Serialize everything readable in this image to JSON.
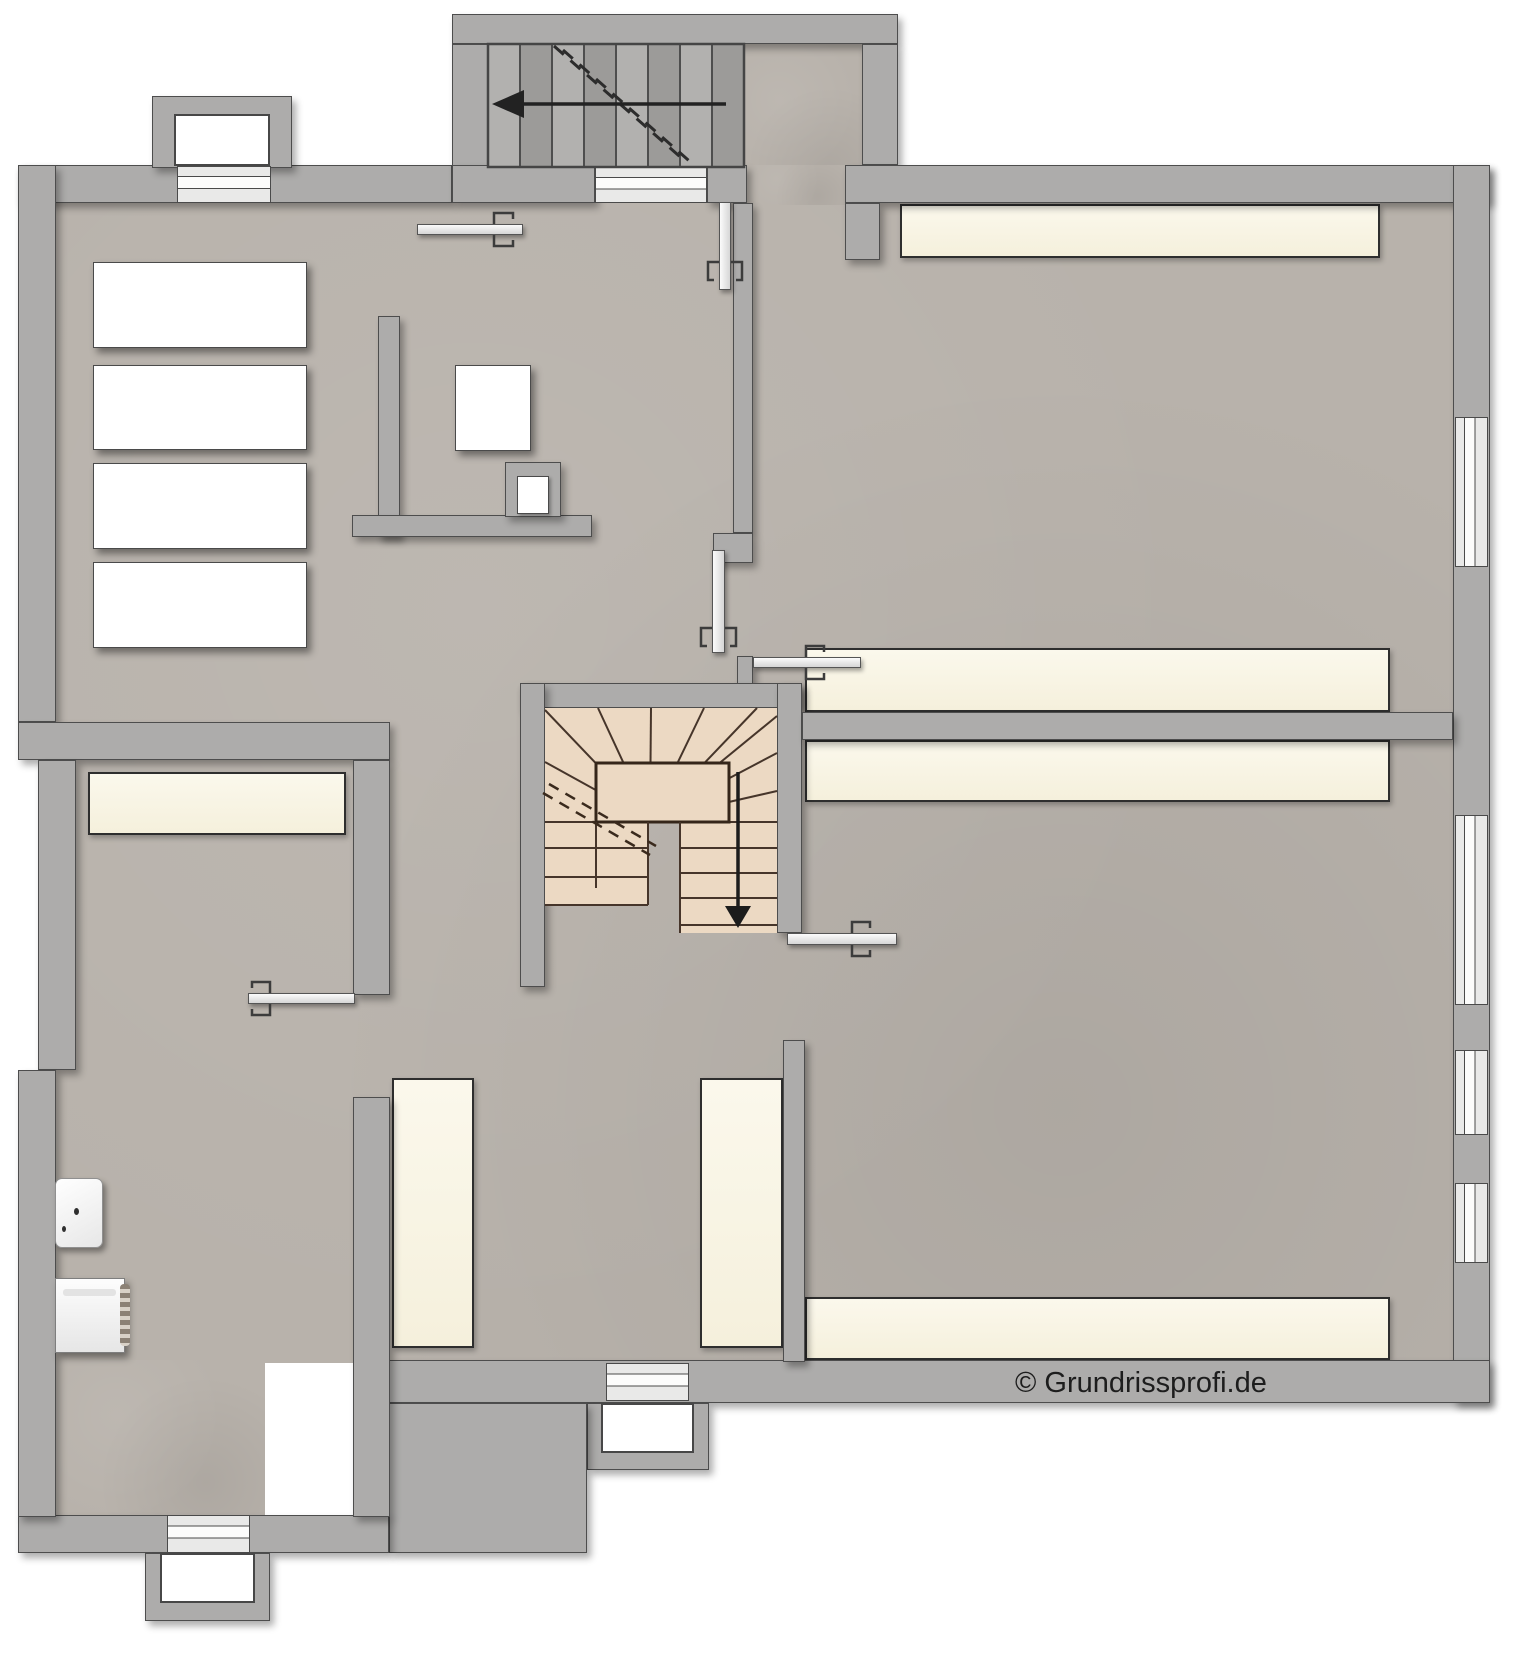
{
  "canvas": {
    "w": 1520,
    "h": 1656
  },
  "copyright": {
    "text": "© Grundrissprofi.de",
    "x": 1015,
    "y": 1367
  },
  "palette": {
    "floor": "#b8b2ab",
    "wall": "#adacab",
    "wall_line": "#4d4d4d",
    "platform_cream": "#f9f6e8",
    "stair_tread": "#ecd9c3",
    "stair_line": "#46352a",
    "exterior_tread": "#a7a6a4"
  },
  "plan": {
    "floors": [
      {
        "name": "floor-main",
        "x": 53,
        "y": 200,
        "w": 1402,
        "h": 1163
      },
      {
        "name": "floor-bottom-left-room",
        "x": 53,
        "y": 1360,
        "w": 212,
        "h": 157
      },
      {
        "name": "floor-stair-landing",
        "x": 744,
        "y": 44,
        "w": 118,
        "h": 160
      },
      {
        "name": "floor-top-opening",
        "x": 747,
        "y": 165,
        "w": 98,
        "h": 40
      }
    ],
    "platforms": [
      {
        "name": "platform-top-right-room",
        "x": 900,
        "y": 204,
        "w": 480,
        "h": 54
      },
      {
        "name": "platform-upper-right-room-bottom",
        "x": 805,
        "y": 648,
        "w": 585,
        "h": 64
      },
      {
        "name": "platform-lower-right-room-top",
        "x": 805,
        "y": 740,
        "w": 585,
        "h": 62
      },
      {
        "name": "platform-lower-right-room-bottom",
        "x": 805,
        "y": 1297,
        "w": 585,
        "h": 63
      },
      {
        "name": "platform-left-room-top",
        "x": 88,
        "y": 772,
        "w": 258,
        "h": 63
      },
      {
        "name": "platform-middle-room-left",
        "x": 392,
        "y": 1078,
        "w": 82,
        "h": 270
      },
      {
        "name": "platform-middle-room-right",
        "x": 700,
        "y": 1078,
        "w": 83,
        "h": 270
      }
    ],
    "walls": [
      {
        "name": "wall-top-left",
        "x": 18,
        "y": 165,
        "w": 434,
        "h": 38
      },
      {
        "name": "lightwell-top-left-ring",
        "x": 152,
        "y": 96,
        "w": 140,
        "h": 72
      },
      {
        "name": "wall-exterior-stair-top",
        "x": 452,
        "y": 14,
        "w": 446,
        "h": 30
      },
      {
        "name": "wall-exterior-stair-left",
        "x": 452,
        "y": 44,
        "w": 36,
        "h": 123
      },
      {
        "name": "wall-exterior-stair-right",
        "x": 862,
        "y": 44,
        "w": 36,
        "h": 121
      },
      {
        "name": "wall-under-stair-a",
        "x": 452,
        "y": 165,
        "w": 143,
        "h": 38
      },
      {
        "name": "wall-under-stair-b",
        "x": 707,
        "y": 165,
        "w": 40,
        "h": 38
      },
      {
        "name": "wall-top-right",
        "x": 845,
        "y": 165,
        "w": 645,
        "h": 38
      },
      {
        "name": "wall-stub-top-right",
        "x": 845,
        "y": 203,
        "w": 35,
        "h": 57
      },
      {
        "name": "wall-right",
        "x": 1453,
        "y": 165,
        "w": 37,
        "h": 1238
      },
      {
        "name": "wall-bottom-right",
        "x": 389,
        "y": 1360,
        "w": 1101,
        "h": 43
      },
      {
        "name": "lightwell-bottom-middle-ring",
        "x": 587,
        "y": 1403,
        "w": 122,
        "h": 67
      },
      {
        "name": "wall-block-bottom",
        "x": 389,
        "y": 1403,
        "w": 198,
        "h": 150
      },
      {
        "name": "wall-bottom-left",
        "x": 18,
        "y": 1515,
        "w": 371,
        "h": 38
      },
      {
        "name": "lightwell-bottom-left-ring",
        "x": 145,
        "y": 1553,
        "w": 125,
        "h": 68
      },
      {
        "name": "wall-left-upper",
        "x": 18,
        "y": 165,
        "w": 38,
        "h": 557
      },
      {
        "name": "wall-divider-left-rooms",
        "x": 18,
        "y": 722,
        "w": 372,
        "h": 38
      },
      {
        "name": "wall-left-middle",
        "x": 38,
        "y": 760,
        "w": 38,
        "h": 310
      },
      {
        "name": "wall-left-lower",
        "x": 18,
        "y": 1070,
        "w": 38,
        "h": 447
      },
      {
        "name": "wall-leftroom-right-upper",
        "x": 353,
        "y": 760,
        "w": 37,
        "h": 235
      },
      {
        "name": "wall-leftroom-right-lower",
        "x": 353,
        "y": 1097,
        "w": 37,
        "h": 420
      },
      {
        "name": "partition-storage-vertical",
        "x": 378,
        "y": 316,
        "w": 22,
        "h": 221
      },
      {
        "name": "partition-storage-horizontal",
        "x": 352,
        "y": 515,
        "w": 240,
        "h": 22
      },
      {
        "name": "partition-chimney-bump",
        "x": 505,
        "y": 462,
        "w": 56,
        "h": 55
      },
      {
        "name": "wall-middle-vertical",
        "x": 733,
        "y": 203,
        "w": 20,
        "h": 330
      },
      {
        "name": "wall-middle-foot",
        "x": 713,
        "y": 533,
        "w": 40,
        "h": 30
      },
      {
        "name": "wall-stub-door-jamb",
        "x": 737,
        "y": 656,
        "w": 16,
        "h": 29
      },
      {
        "name": "stair-enclosure-top",
        "x": 520,
        "y": 683,
        "w": 282,
        "h": 25
      },
      {
        "name": "stair-enclosure-left",
        "x": 520,
        "y": 683,
        "w": 25,
        "h": 304
      },
      {
        "name": "stair-enclosure-right",
        "x": 777,
        "y": 683,
        "w": 25,
        "h": 250
      },
      {
        "name": "wall-middle-room-right",
        "x": 783,
        "y": 1040,
        "w": 22,
        "h": 322
      },
      {
        "name": "wall-divider-right-rooms",
        "x": 802,
        "y": 712,
        "w": 651,
        "h": 28
      }
    ],
    "whites": [
      {
        "name": "lightwell-top-left-inner",
        "cls": "well-inner",
        "x": 174,
        "y": 114,
        "w": 96,
        "h": 52
      },
      {
        "name": "lightwell-bottom-middle-inner",
        "cls": "well-inner",
        "x": 601,
        "y": 1403,
        "w": 93,
        "h": 50
      },
      {
        "name": "lightwell-bottom-left-inner",
        "cls": "well-inner",
        "x": 160,
        "y": 1553,
        "w": 95,
        "h": 50
      },
      {
        "name": "shelf-1",
        "cls": "shelf",
        "x": 93,
        "y": 262,
        "w": 214,
        "h": 86
      },
      {
        "name": "shelf-2",
        "cls": "shelf",
        "x": 93,
        "y": 365,
        "w": 214,
        "h": 85
      },
      {
        "name": "shelf-3",
        "cls": "shelf",
        "x": 93,
        "y": 463,
        "w": 214,
        "h": 86
      },
      {
        "name": "shelf-4",
        "cls": "shelf",
        "x": 93,
        "y": 562,
        "w": 214,
        "h": 86
      },
      {
        "name": "table-box",
        "cls": "shelf",
        "x": 455,
        "y": 365,
        "w": 76,
        "h": 86
      },
      {
        "name": "chimney-inner-box",
        "cls": "small-box",
        "x": 517,
        "y": 476,
        "w": 32,
        "h": 38
      }
    ],
    "windows_h": [
      {
        "name": "window-top-left",
        "x": 177,
        "y": 166,
        "w": 94,
        "h": 37
      },
      {
        "name": "window-under-stair",
        "x": 595,
        "y": 167,
        "w": 112,
        "h": 36
      },
      {
        "name": "window-bottom-left",
        "x": 167,
        "y": 1515,
        "w": 83,
        "h": 38
      },
      {
        "name": "window-bottom-middle",
        "x": 606,
        "y": 1363,
        "w": 83,
        "h": 38
      }
    ],
    "windows_v": [
      {
        "name": "window-right-1",
        "x": 1455,
        "y": 417,
        "w": 33,
        "h": 150
      },
      {
        "name": "window-right-2",
        "x": 1455,
        "y": 815,
        "w": 33,
        "h": 190
      },
      {
        "name": "window-right-3",
        "x": 1455,
        "y": 1050,
        "w": 33,
        "h": 85
      },
      {
        "name": "window-right-4",
        "x": 1455,
        "y": 1183,
        "w": 33,
        "h": 80
      }
    ],
    "doors": [
      {
        "name": "door-storage-room",
        "dir": "h",
        "x": 417,
        "y": 224,
        "w": 106,
        "h": 11
      },
      {
        "name": "door-top-entry",
        "dir": "v",
        "x": 719,
        "y": 202,
        "w": 12,
        "h": 88
      },
      {
        "name": "door-corridor-middle",
        "dir": "v",
        "x": 712,
        "y": 550,
        "w": 13,
        "h": 103
      },
      {
        "name": "door-upper-right-room",
        "dir": "h",
        "x": 753,
        "y": 657,
        "w": 108,
        "h": 11
      },
      {
        "name": "door-lower-right-room",
        "dir": "h",
        "x": 787,
        "y": 933,
        "w": 110,
        "h": 12
      },
      {
        "name": "door-left-room",
        "dir": "h",
        "x": 248,
        "y": 993,
        "w": 107,
        "h": 11
      }
    ],
    "objects": [
      {
        "name": "sink",
        "cls": "sink",
        "x": 55,
        "y": 1178,
        "w": 48,
        "h": 70
      },
      {
        "name": "sink-drain-dot",
        "cls": "dot",
        "x": 74,
        "y": 1208,
        "w": 5,
        "h": 7
      },
      {
        "name": "sink-tap-dot",
        "cls": "dot",
        "x": 62,
        "y": 1226,
        "w": 4,
        "h": 6
      },
      {
        "name": "heater-boiler",
        "cls": "heater",
        "x": 55,
        "y": 1278,
        "w": 70,
        "h": 75
      },
      {
        "name": "heater-groove",
        "cls": "groove",
        "x": 63,
        "y": 1289,
        "w": 53,
        "h": 7
      },
      {
        "name": "heater-coil",
        "cls": "coil",
        "x": 120,
        "y": 1284,
        "w": 10,
        "h": 62
      }
    ]
  },
  "svg_shapes": [
    {
      "t": "rect",
      "x": 488,
      "y": 44,
      "w": 256,
      "h": 123,
      "f": "#a7a6a4"
    },
    {
      "t": "rect",
      "x": 488,
      "y": 44,
      "w": 32,
      "h": 123,
      "f": "#b2b1af"
    },
    {
      "t": "rect",
      "x": 520,
      "y": 44,
      "w": 32,
      "h": 123,
      "f": "#9c9b99"
    },
    {
      "t": "rect",
      "x": 552,
      "y": 44,
      "w": 32,
      "h": 123,
      "f": "#b2b1af"
    },
    {
      "t": "rect",
      "x": 584,
      "y": 44,
      "w": 32,
      "h": 123,
      "f": "#9c9b99"
    },
    {
      "t": "rect",
      "x": 616,
      "y": 44,
      "w": 32,
      "h": 123,
      "f": "#b2b1af"
    },
    {
      "t": "rect",
      "x": 648,
      "y": 44,
      "w": 32,
      "h": 123,
      "f": "#9c9b99"
    },
    {
      "t": "rect",
      "x": 680,
      "y": 44,
      "w": 32,
      "h": 123,
      "f": "#b2b1af"
    },
    {
      "t": "rect",
      "x": 712,
      "y": 44,
      "w": 32,
      "h": 123,
      "f": "#9c9b99"
    },
    {
      "t": "line",
      "x1": 520,
      "y1": 44,
      "x2": 520,
      "y2": 167,
      "s": "#4e4e4e",
      "sw": 2
    },
    {
      "t": "line",
      "x1": 552,
      "y1": 44,
      "x2": 552,
      "y2": 167,
      "s": "#4e4e4e",
      "sw": 2
    },
    {
      "t": "line",
      "x1": 584,
      "y1": 44,
      "x2": 584,
      "y2": 167,
      "s": "#4e4e4e",
      "sw": 2
    },
    {
      "t": "line",
      "x1": 616,
      "y1": 44,
      "x2": 616,
      "y2": 167,
      "s": "#4e4e4e",
      "sw": 2
    },
    {
      "t": "line",
      "x1": 648,
      "y1": 44,
      "x2": 648,
      "y2": 167,
      "s": "#4e4e4e",
      "sw": 2
    },
    {
      "t": "line",
      "x1": 680,
      "y1": 44,
      "x2": 680,
      "y2": 167,
      "s": "#4e4e4e",
      "sw": 2
    },
    {
      "t": "line",
      "x1": 712,
      "y1": 44,
      "x2": 712,
      "y2": 167,
      "s": "#4e4e4e",
      "sw": 2
    },
    {
      "t": "rect",
      "x": 488,
      "y": 44,
      "w": 256,
      "h": 123,
      "s": "#454545",
      "sw": 2.5
    },
    {
      "t": "line",
      "x1": 554,
      "y1": 46,
      "x2": 686,
      "y2": 162,
      "s": "#2c2c2c",
      "sw": 3,
      "d": "13 9"
    },
    {
      "t": "line",
      "x1": 563,
      "y1": 50,
      "x2": 695,
      "y2": 166,
      "s": "#2c2c2c",
      "sw": 3,
      "d": "13 9"
    },
    {
      "t": "line",
      "x1": 726,
      "y1": 104,
      "x2": 506,
      "y2": 104,
      "s": "#222222",
      "sw": 3.5
    },
    {
      "t": "poly",
      "pts": "492,104 524,90 524,118",
      "f": "#222222"
    },
    {
      "t": "rect",
      "x": 545,
      "y": 708,
      "w": 232,
      "h": 114,
      "f": "#ecd9c3"
    },
    {
      "t": "rect",
      "x": 545,
      "y": 822,
      "w": 103,
      "h": 83,
      "f": "#ecd9c3"
    },
    {
      "t": "rect",
      "x": 680,
      "y": 822,
      "w": 97,
      "h": 111,
      "f": "#ecd9c3"
    },
    {
      "t": "line",
      "x1": 650,
      "y1": 820,
      "x2": 545,
      "y2": 762,
      "s": "#46352a",
      "sw": 2
    },
    {
      "t": "line",
      "x1": 650,
      "y1": 820,
      "x2": 545,
      "y2": 710,
      "s": "#46352a",
      "sw": 2
    },
    {
      "t": "line",
      "x1": 650,
      "y1": 820,
      "x2": 598,
      "y2": 708,
      "s": "#46352a",
      "sw": 2
    },
    {
      "t": "line",
      "x1": 650,
      "y1": 820,
      "x2": 651,
      "y2": 708,
      "s": "#46352a",
      "sw": 2
    },
    {
      "t": "line",
      "x1": 650,
      "y1": 820,
      "x2": 704,
      "y2": 708,
      "s": "#46352a",
      "sw": 2
    },
    {
      "t": "line",
      "x1": 650,
      "y1": 820,
      "x2": 757,
      "y2": 708,
      "s": "#46352a",
      "sw": 2
    },
    {
      "t": "line",
      "x1": 650,
      "y1": 820,
      "x2": 777,
      "y2": 716,
      "s": "#46352a",
      "sw": 2
    },
    {
      "t": "line",
      "x1": 650,
      "y1": 820,
      "x2": 777,
      "y2": 753,
      "s": "#46352a",
      "sw": 2
    },
    {
      "t": "line",
      "x1": 650,
      "y1": 820,
      "x2": 777,
      "y2": 791,
      "s": "#46352a",
      "sw": 2
    },
    {
      "t": "line",
      "x1": 545,
      "y1": 822,
      "x2": 777,
      "y2": 822,
      "s": "#46352a",
      "sw": 2
    },
    {
      "t": "rect",
      "x": 596,
      "y": 763,
      "w": 133,
      "h": 59,
      "f": "#ecd9c3",
      "s": "#35261a",
      "sw": 3
    },
    {
      "t": "line",
      "x1": 545,
      "y1": 848,
      "x2": 648,
      "y2": 848,
      "s": "#46352a",
      "sw": 2
    },
    {
      "t": "line",
      "x1": 545,
      "y1": 877,
      "x2": 648,
      "y2": 877,
      "s": "#46352a",
      "sw": 2
    },
    {
      "t": "line",
      "x1": 545,
      "y1": 905,
      "x2": 648,
      "y2": 905,
      "s": "#46352a",
      "sw": 2
    },
    {
      "t": "line",
      "x1": 648,
      "y1": 822,
      "x2": 648,
      "y2": 905,
      "s": "#46352a",
      "sw": 2
    },
    {
      "t": "line",
      "x1": 596,
      "y1": 822,
      "x2": 596,
      "y2": 888,
      "s": "#46352a",
      "sw": 2
    },
    {
      "t": "line",
      "x1": 680,
      "y1": 848,
      "x2": 777,
      "y2": 848,
      "s": "#46352a",
      "sw": 2
    },
    {
      "t": "line",
      "x1": 680,
      "y1": 873,
      "x2": 777,
      "y2": 873,
      "s": "#46352a",
      "sw": 2
    },
    {
      "t": "line",
      "x1": 680,
      "y1": 898,
      "x2": 777,
      "y2": 898,
      "s": "#46352a",
      "sw": 2
    },
    {
      "t": "line",
      "x1": 680,
      "y1": 925,
      "x2": 777,
      "y2": 925,
      "s": "#46352a",
      "sw": 2
    },
    {
      "t": "line",
      "x1": 680,
      "y1": 822,
      "x2": 680,
      "y2": 933,
      "s": "#46352a",
      "sw": 2
    },
    {
      "t": "line",
      "x1": 549,
      "y1": 784,
      "x2": 656,
      "y2": 846,
      "s": "#3a2a1d",
      "sw": 2.5,
      "d": "11 8"
    },
    {
      "t": "line",
      "x1": 543,
      "y1": 793,
      "x2": 650,
      "y2": 855,
      "s": "#3a2a1d",
      "sw": 2.5,
      "d": "11 8"
    },
    {
      "t": "line",
      "x1": 738,
      "y1": 772,
      "x2": 738,
      "y2": 908,
      "s": "#1c1c1c",
      "sw": 3.5
    },
    {
      "t": "poly",
      "pts": "738,928 725,906 751,906",
      "f": "#1c1c1c"
    },
    {
      "t": "pline",
      "pts": "494,224 494,213 513,213 513,219",
      "s": "#3c3c3c",
      "sw": 2.5
    },
    {
      "t": "pline",
      "pts": "494,235 494,246 513,246 513,240",
      "s": "#3c3c3c",
      "sw": 2.5
    },
    {
      "t": "pline",
      "pts": "719,262 708,262 708,280 714,280",
      "s": "#3c3c3c",
      "sw": 2.5
    },
    {
      "t": "pline",
      "pts": "731,262 742,262 742,280 736,280",
      "s": "#3c3c3c",
      "sw": 2.5
    },
    {
      "t": "pline",
      "pts": "712,628 701,628 701,646 707,646",
      "s": "#3c3c3c",
      "sw": 2.5
    },
    {
      "t": "pline",
      "pts": "725,628 736,628 736,646 730,646",
      "s": "#3c3c3c",
      "sw": 2.5
    },
    {
      "t": "pline",
      "pts": "806,657 806,646 824,646 824,652",
      "s": "#3c3c3c",
      "sw": 2.5
    },
    {
      "t": "pline",
      "pts": "806,668 806,679 824,679 824,673",
      "s": "#3c3c3c",
      "sw": 2.5
    },
    {
      "t": "pline",
      "pts": "852,933 852,922 870,922 870,928",
      "s": "#3c3c3c",
      "sw": 2.5
    },
    {
      "t": "pline",
      "pts": "852,945 852,956 870,956 870,950",
      "s": "#3c3c3c",
      "sw": 2.5
    },
    {
      "t": "pline",
      "pts": "270,993 270,982 252,982 252,988",
      "s": "#3c3c3c",
      "sw": 2.5
    },
    {
      "t": "pline",
      "pts": "270,1004 270,1015 252,1015 252,1009",
      "s": "#3c3c3c",
      "sw": 2.5
    }
  ]
}
